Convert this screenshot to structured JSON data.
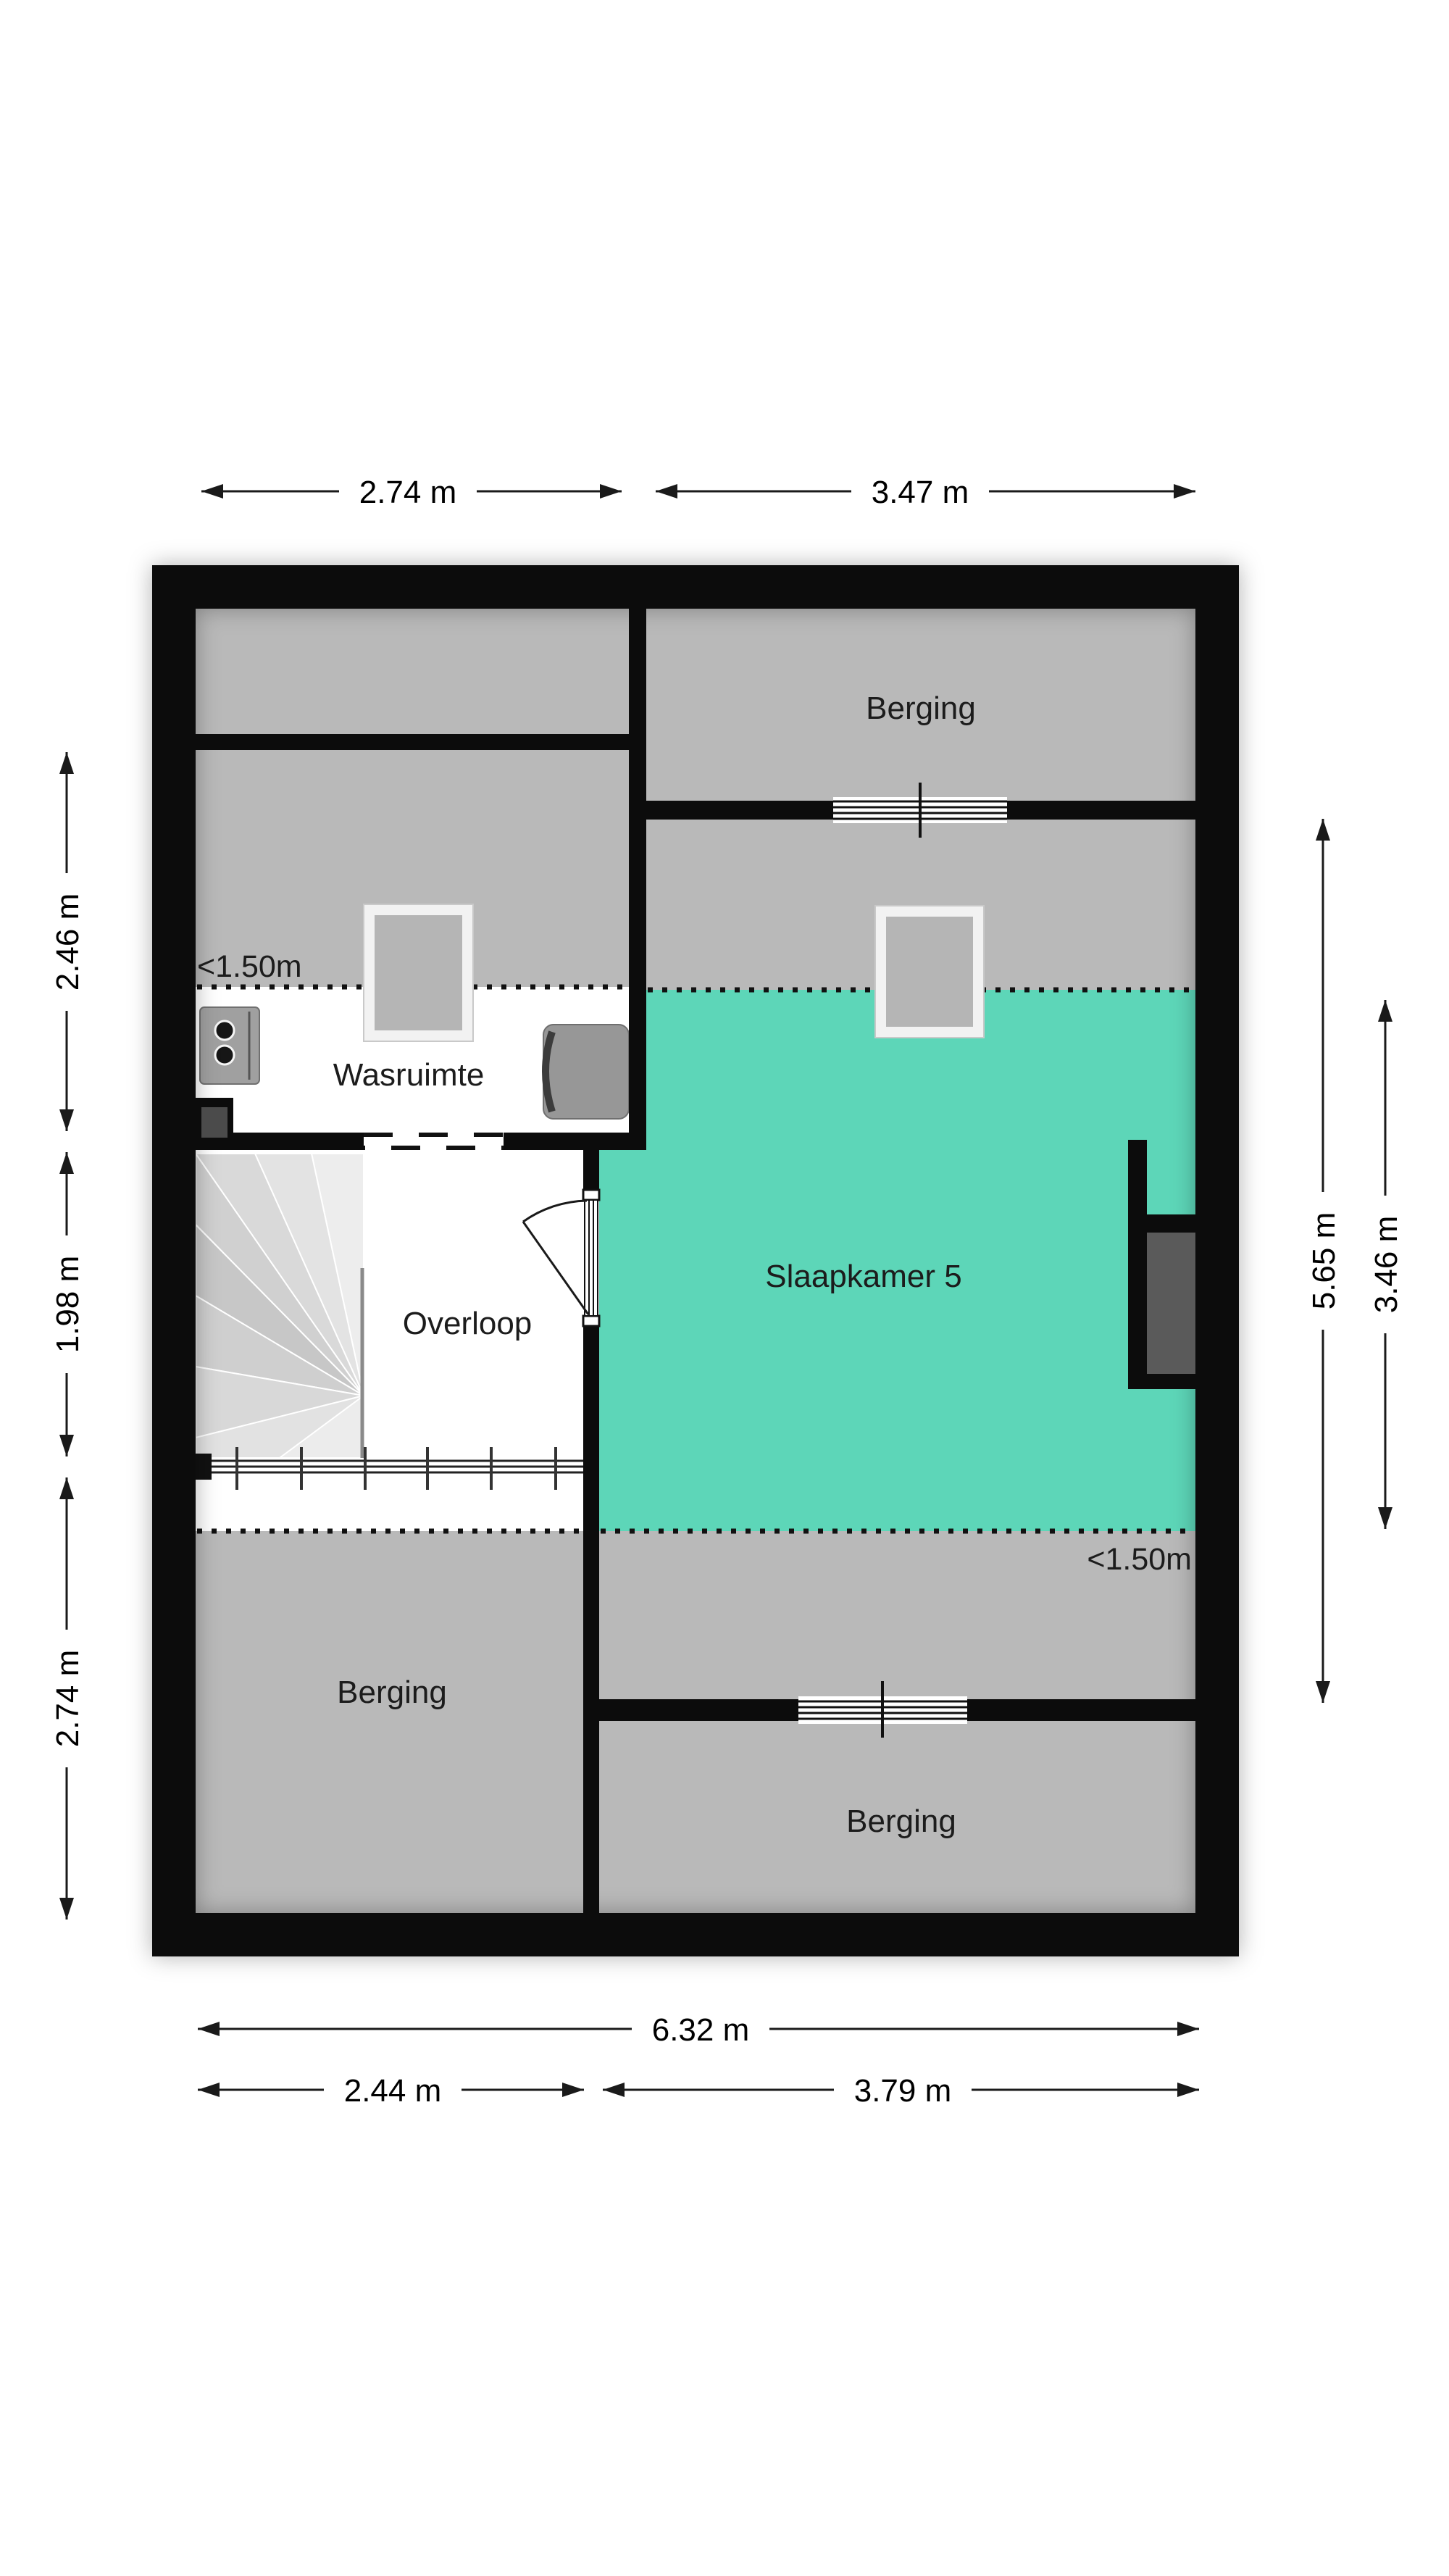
{
  "floorplan": {
    "rooms": {
      "berging_top": "Berging",
      "wasruimte": "Wasruimte",
      "slaapkamer_5": "Slaapkamer 5",
      "overloop": "Overloop",
      "berging_bottom_left": "Berging",
      "berging_bottom_right": "Berging"
    },
    "annotations": {
      "low_headroom_left": "<1.50m",
      "low_headroom_right": "<1.50m"
    },
    "dimensions": {
      "top": [
        "2.74 m",
        "3.47 m"
      ],
      "bottom_total": "6.32 m",
      "bottom_left": "2.44 m",
      "bottom_right": "3.79 m",
      "left": [
        "2.46 m",
        "1.98 m",
        "2.74 m"
      ],
      "right": [
        "5.65 m",
        "3.46 m"
      ]
    },
    "colors": {
      "wall": "#0c0c0c",
      "low_area_gray": "#b9b9b9",
      "slaapkamer_fill": "#5dd6b8",
      "niche_panel": "#5a5a5a",
      "text": "#1c1c1c"
    }
  }
}
